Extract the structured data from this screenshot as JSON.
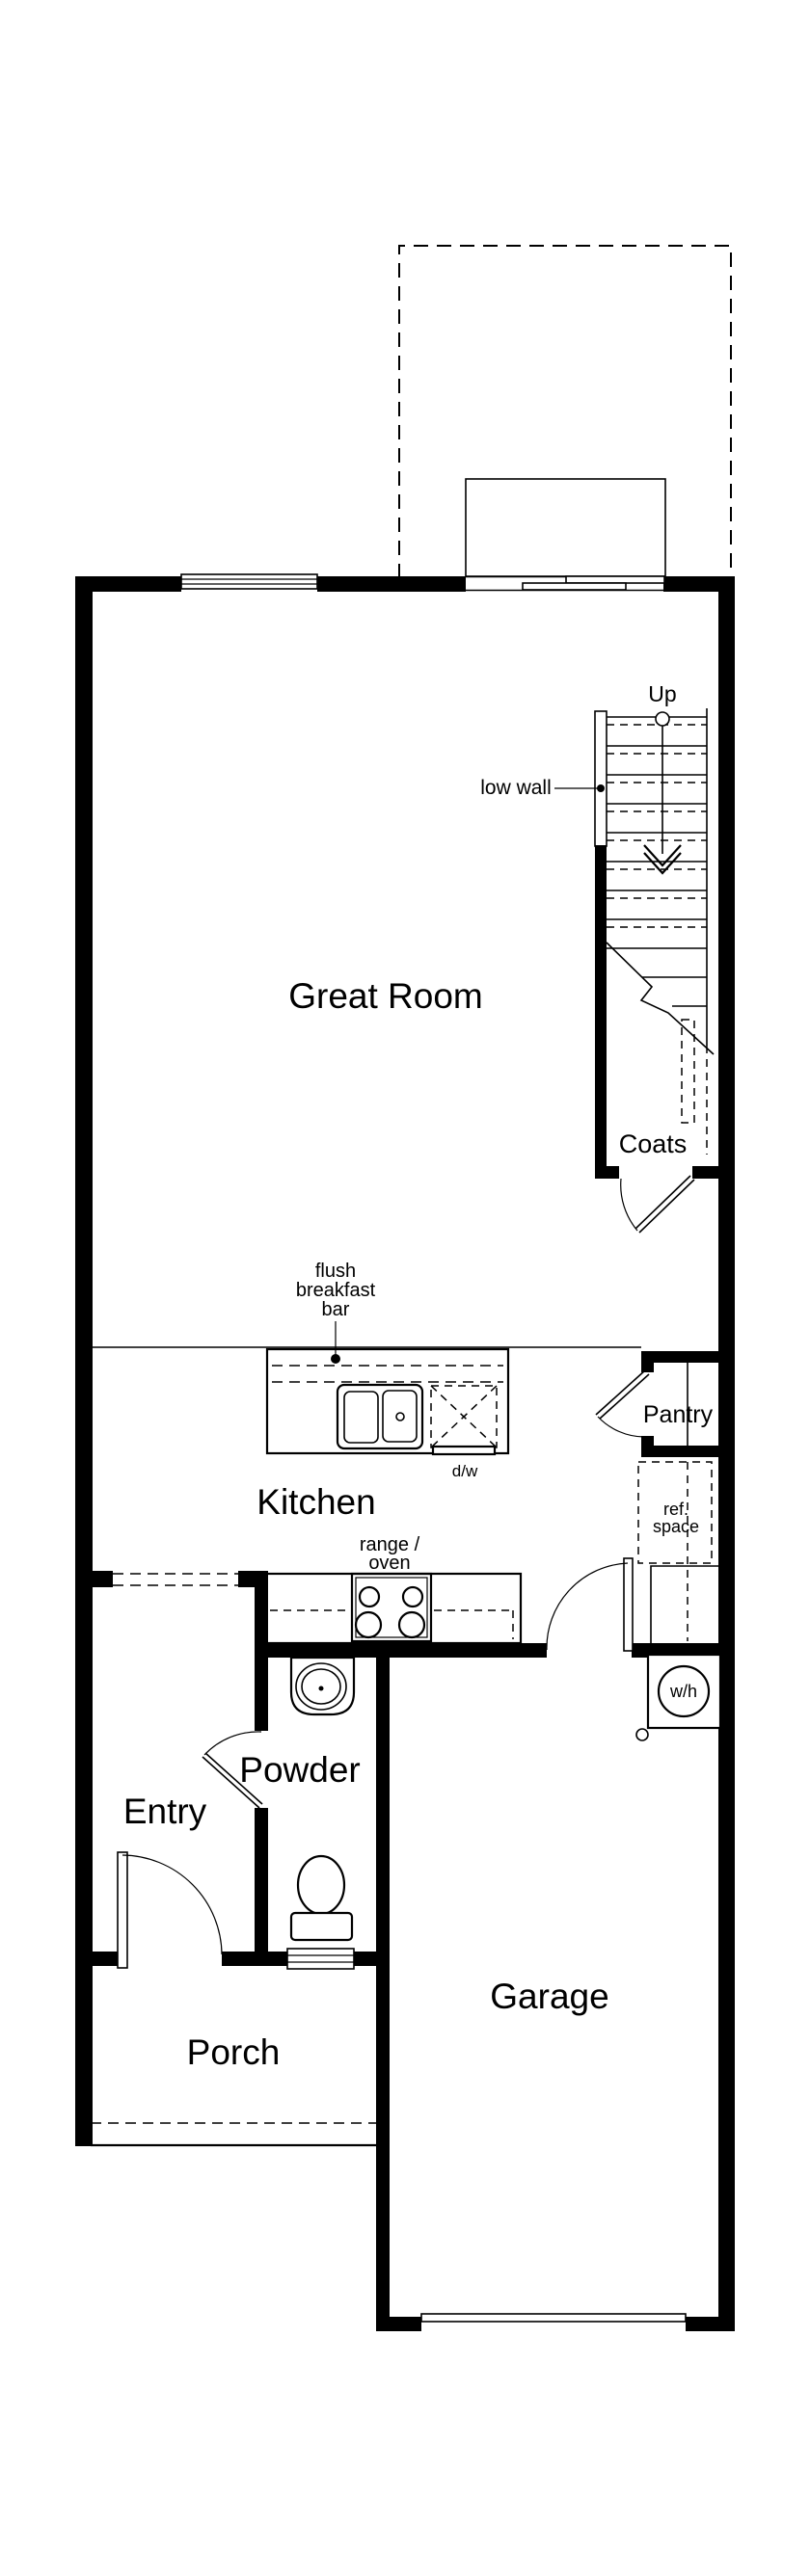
{
  "plan": {
    "rooms": {
      "great_room": "Great Room",
      "kitchen": "Kitchen",
      "entry": "Entry",
      "powder": "Powder",
      "porch": "Porch",
      "garage": "Garage",
      "pantry": "Pantry",
      "coats": "Coats"
    },
    "annotations": {
      "up": "Up",
      "low_wall": "low wall",
      "flush_bar": [
        "flush",
        "breakfast",
        "bar"
      ],
      "range_oven": [
        "range /",
        "oven"
      ],
      "dw": "d/w",
      "ref_space": [
        "ref.",
        "space"
      ],
      "wh": "w/h"
    },
    "colors": {
      "line": "#000000",
      "background": "#ffffff"
    }
  }
}
